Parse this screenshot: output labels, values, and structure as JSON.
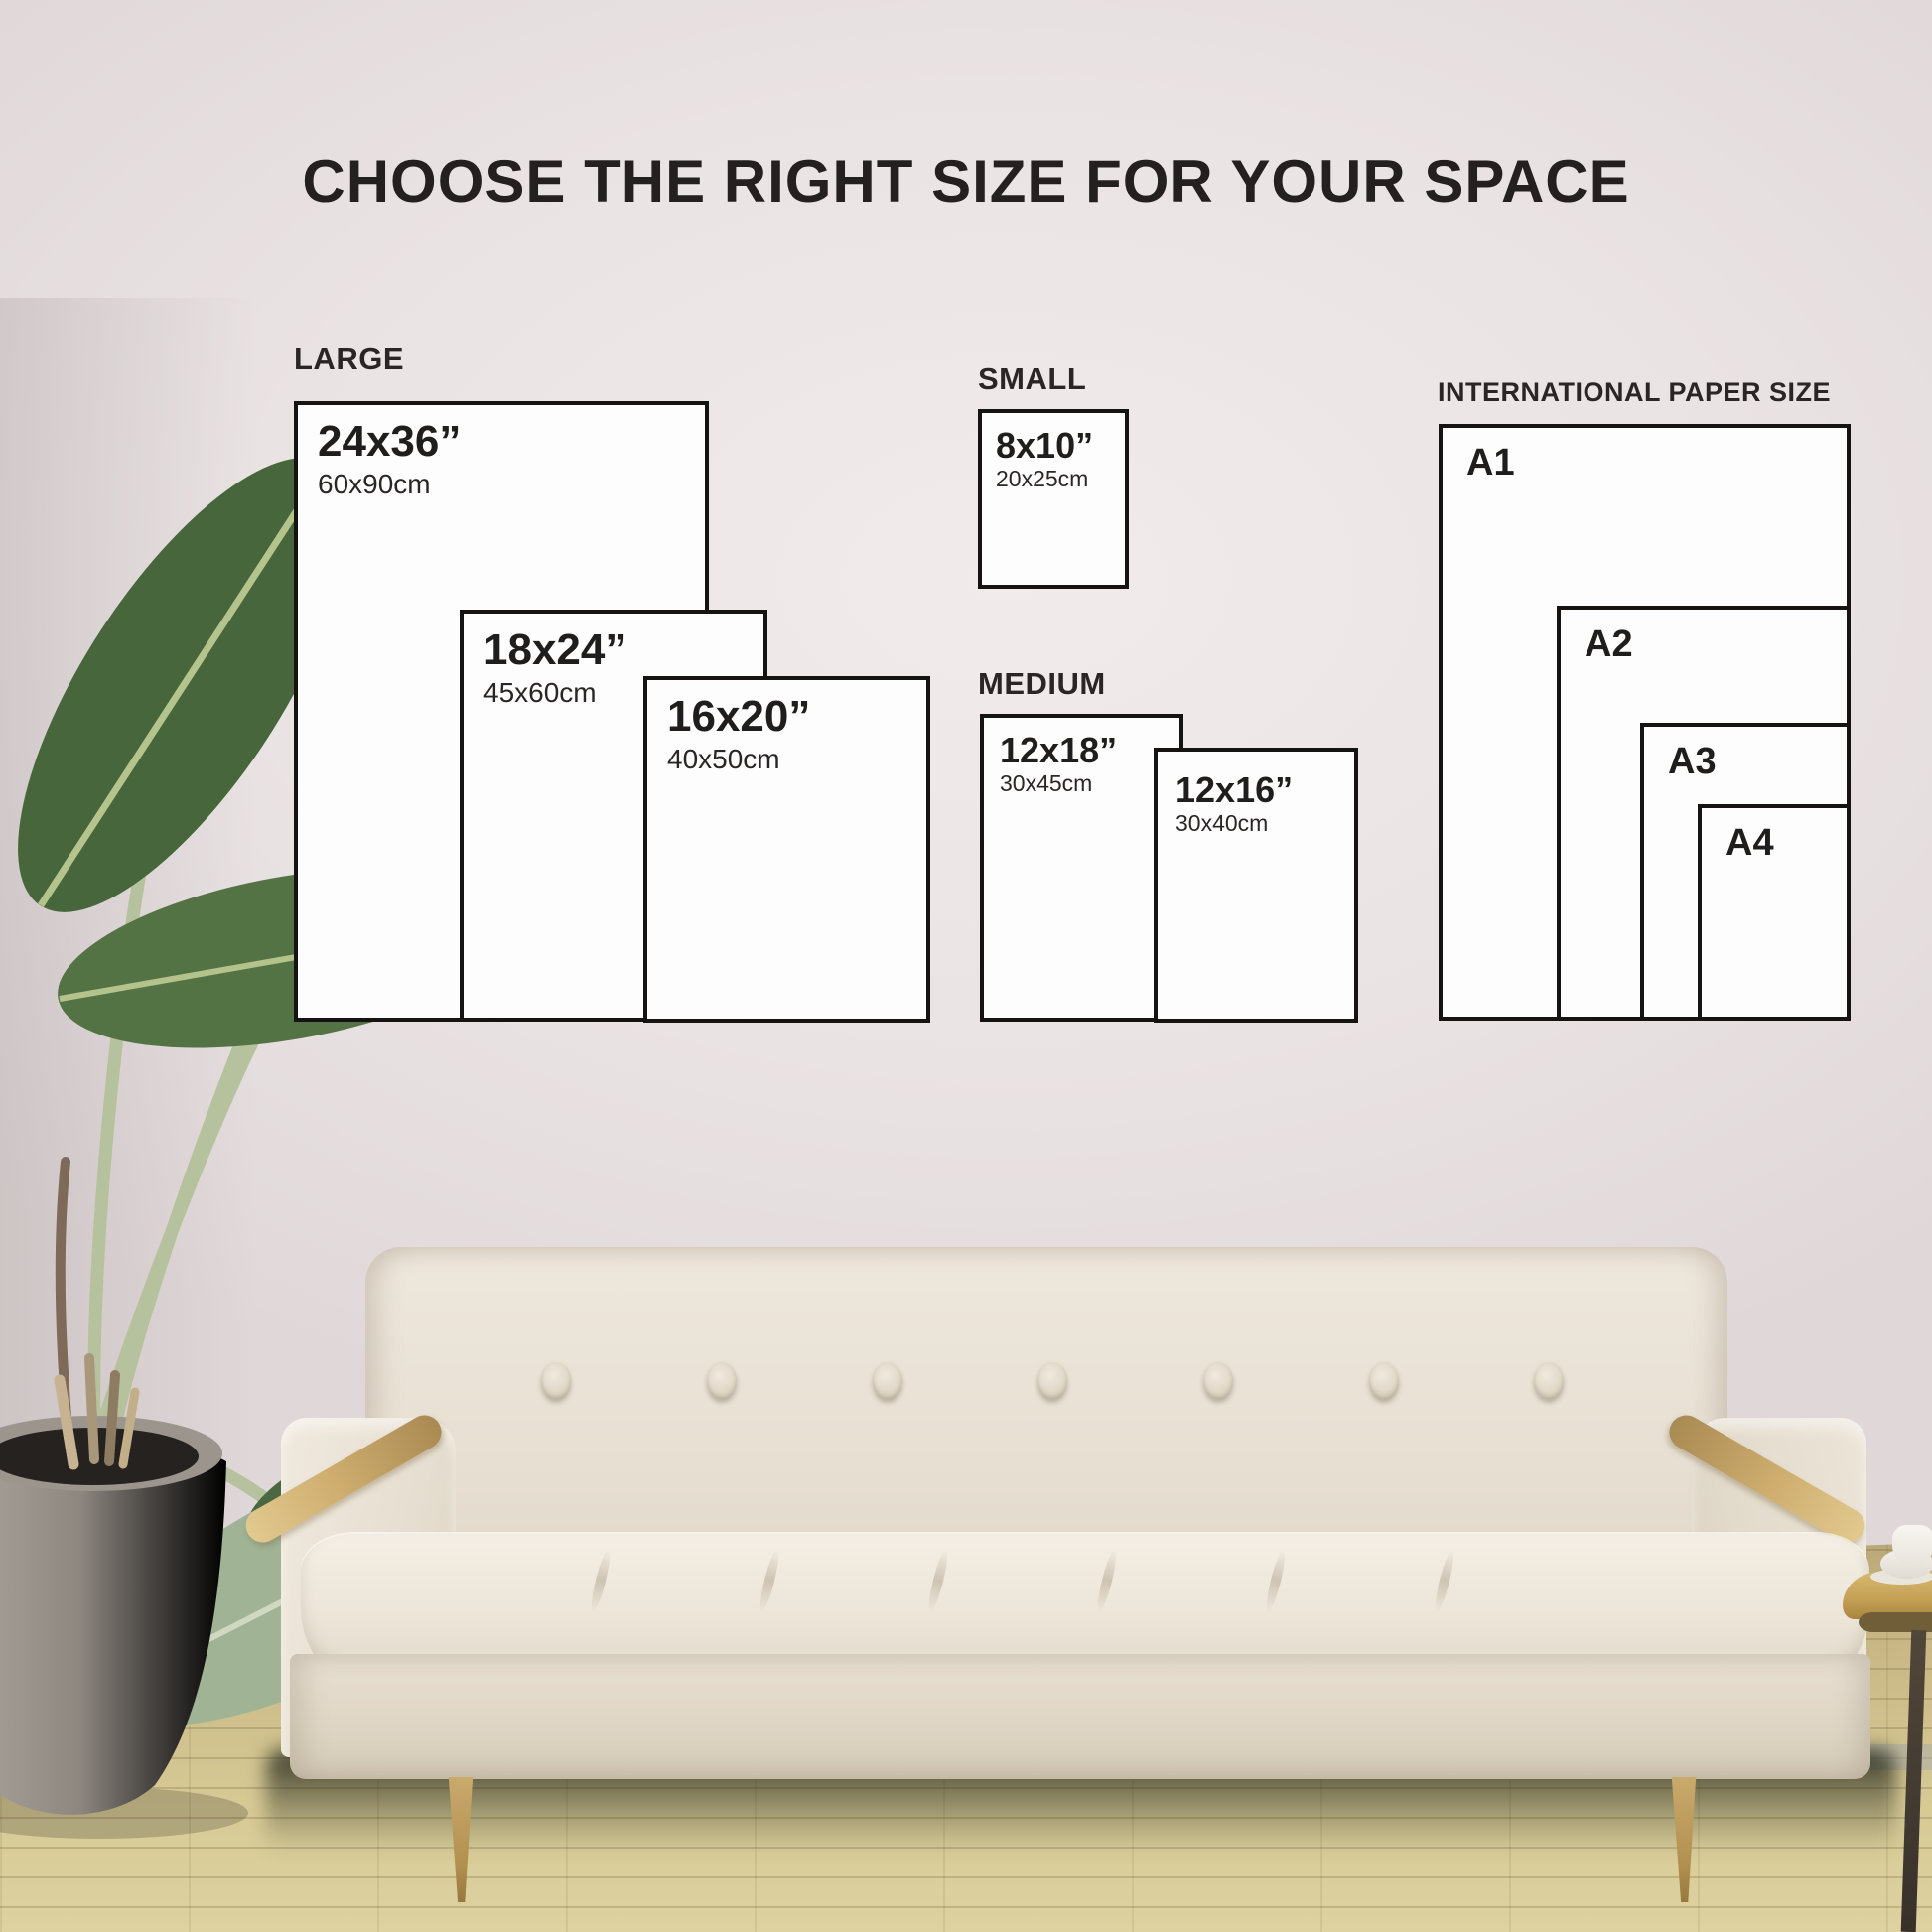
{
  "title": "CHOOSE THE RIGHT SIZE FOR YOUR SPACE",
  "groups": {
    "large": {
      "label": "LARGE",
      "sizes": [
        {
          "inches": "24x36”",
          "cm": "60x90cm"
        },
        {
          "inches": "18x24”",
          "cm": "45x60cm"
        },
        {
          "inches": "16x20”",
          "cm": "40x50cm"
        }
      ]
    },
    "small": {
      "label": "SMALL",
      "sizes": [
        {
          "inches": "8x10”",
          "cm": "20x25cm"
        }
      ]
    },
    "medium": {
      "label": "MEDIUM",
      "sizes": [
        {
          "inches": "12x18”",
          "cm": "30x45cm"
        },
        {
          "inches": "12x16”",
          "cm": "30x40cm"
        }
      ]
    },
    "international": {
      "label": "INTERNATIONAL PAPER SIZE",
      "sizes": [
        {
          "name": "A1"
        },
        {
          "name": "A2"
        },
        {
          "name": "A3"
        },
        {
          "name": "A4"
        }
      ]
    }
  },
  "colors": {
    "chart_border": "#161313",
    "chart_fill": "#fdfdfd",
    "text": "#242020",
    "wall": "#eae3e3",
    "floor": "#c8b785",
    "couch_fabric": "#e8e1d5",
    "wood_accent": "#c8a869",
    "pot_grey": "#84807a",
    "leaf_dark": "#4a683e",
    "leaf_light": "#a3b79a"
  }
}
